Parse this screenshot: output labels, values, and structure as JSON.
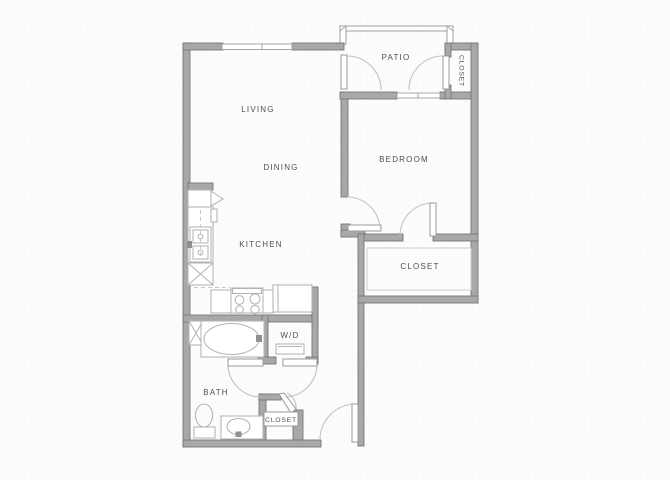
{
  "floorplan": {
    "title": "One-bedroom apartment floor plan",
    "rooms": {
      "living": "LIVING",
      "dining": "DINING",
      "kitchen": "KITCHEN",
      "bedroom": "BEDROOM",
      "patio": "PATIO",
      "bath": "BATH",
      "washer_dryer": "W/D",
      "closet_patio": "CLOSET",
      "closet_walkin": "CLOSET",
      "closet_entry": "CLOSET"
    },
    "fixtures": [
      "refrigerator",
      "kitchen-sink",
      "stove",
      "dishwasher",
      "pantry-cabinet",
      "bathtub",
      "toilet",
      "vanity-sink",
      "washer-dryer",
      "linen-cabinet"
    ],
    "colors": {
      "wall": "#a8a8a8",
      "wall_edge": "#767676",
      "fixture_line": "#b3b3b3",
      "door_arc": "#c2c2c2",
      "label_text": "#4f4f4f",
      "background": "#fcfcfc"
    }
  }
}
